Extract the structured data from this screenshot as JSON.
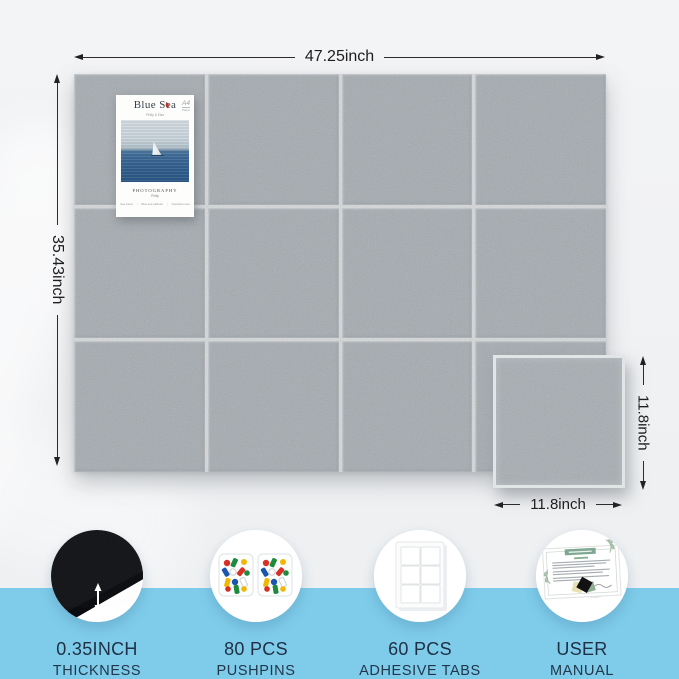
{
  "page": {
    "background": "#f0f1f3",
    "accent_blue": "#7ecbea",
    "felt_color": "#a4abb0",
    "label_color": "#1f3044"
  },
  "board": {
    "width_label": "47.25inch",
    "height_label": "35.43inch",
    "columns": 4,
    "rows": 3
  },
  "single_tile": {
    "height_label": "11.8inch",
    "width_label": "11.8inch"
  },
  "poster": {
    "title": "Blue Sea",
    "subtitle": "Philip & Elsa",
    "paper_size": "A4",
    "paper_word": "Paper",
    "caption": "PHOTOGRAPHY",
    "author": "Philip",
    "footer_items": [
      "Sea travel",
      "Blue sea sailboat",
      "Inspiration sea"
    ],
    "footer_separator": "|"
  },
  "features": [
    {
      "id": "thickness",
      "line1": "0.35INCH",
      "line2": "THICKNESS",
      "icon": "felt-tile-thickness-icon"
    },
    {
      "id": "pushpins",
      "line1": "80 PCS",
      "line2": "PUSHPINS",
      "icon": "pushpins-icon"
    },
    {
      "id": "adhesive-tabs",
      "line1": "60 PCS",
      "line2": "ADHESIVE TABS",
      "icon": "adhesive-tabs-icon"
    },
    {
      "id": "user-manual",
      "line1": "USER",
      "line2": "MANUAL",
      "icon": "user-manual-icon"
    }
  ]
}
